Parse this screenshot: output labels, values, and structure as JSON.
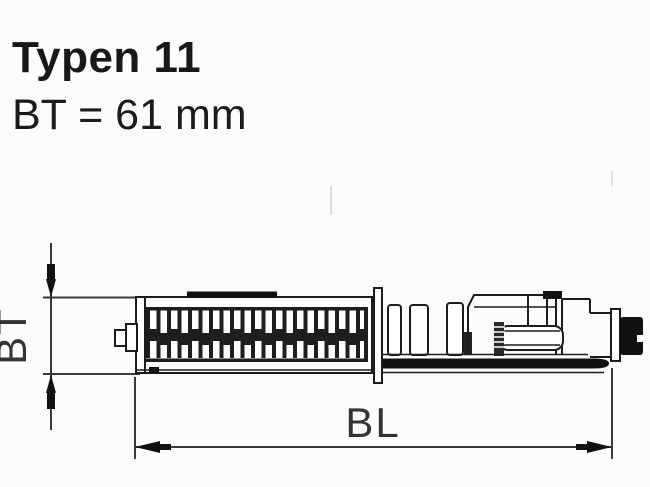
{
  "title": {
    "line1": "Typen 11",
    "line2": "BT = 61 mm"
  },
  "diagram": {
    "type": "radiator-cross-section-top-view",
    "depth_dimension_label": "BT",
    "length_dimension_label": "BL",
    "depth_value_mm": 61
  },
  "colors": {
    "ink": "#1c1c1c",
    "solid_fill": "#111111",
    "dimension_line": "#3a3a3a",
    "title_text": "#17171c",
    "background": "#fcfcfb"
  }
}
